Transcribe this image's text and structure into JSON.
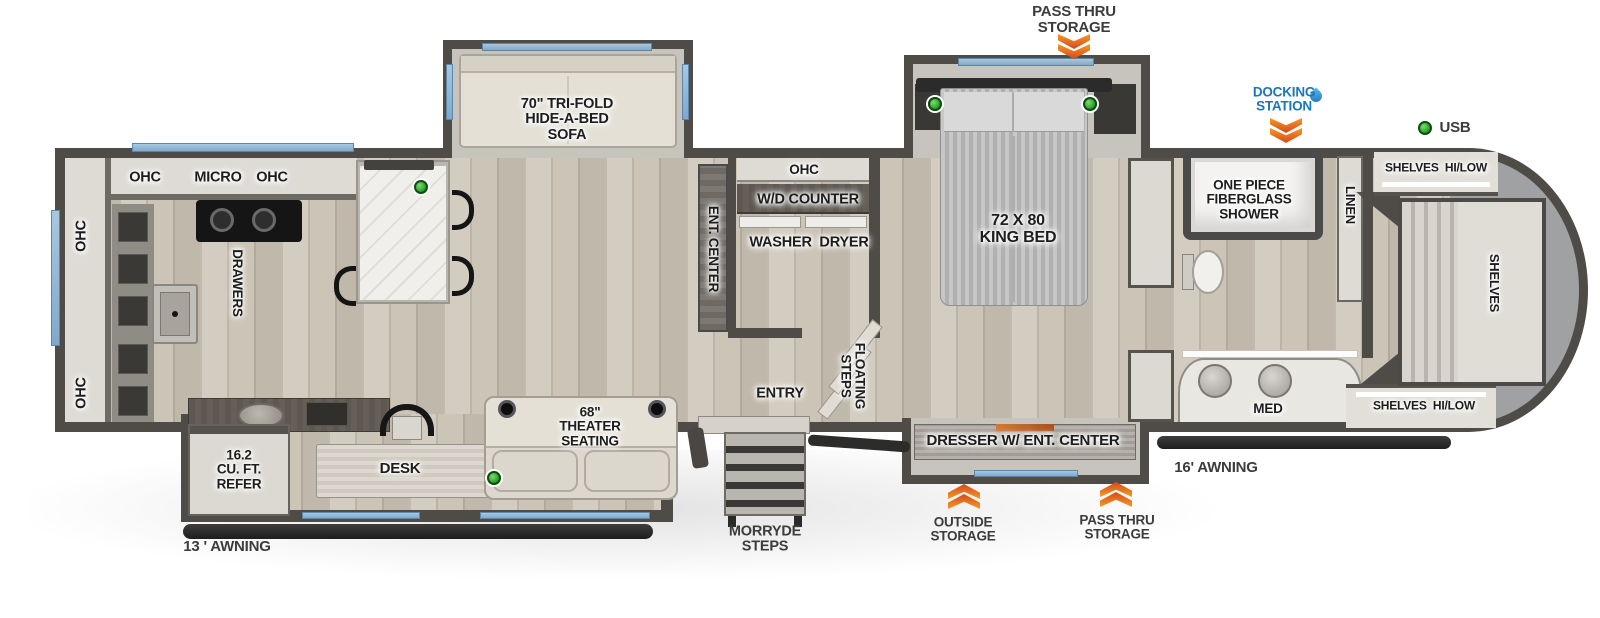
{
  "colors": {
    "wall": "#4f4c48",
    "window_blue": "#8ab4d6",
    "accent_orange": "#e2701f",
    "docking_blue": "#1b75bb",
    "indicator_green": "#2ca22c",
    "floor_wood": "#c8c0b2",
    "front_cap_gray": "#9fa1a3"
  },
  "exterior": {
    "pass_thru_storage_top": "PASS THRU\nSTORAGE",
    "docking_station": "DOCKING\nSTATION",
    "usb": "USB",
    "awning_right": "16' AWNING",
    "outside_storage": "OUTSIDE\nSTORAGE",
    "pass_thru_storage_bottom": "PASS THRU\nSTORAGE",
    "morryde_steps": "MORRYDE\nSTEPS",
    "awning_left": "13 ' AWNING"
  },
  "kitchen": {
    "ohc_rear_left": "OHC",
    "micro": "MICRO",
    "ohc_rear_right": "OHC",
    "ohc_side_upper": "OHC",
    "ohc_side_lower": "OHC",
    "drawers": "DRAWERS",
    "refer": "16.2\nCU. FT.\nREFER"
  },
  "living": {
    "sofa": "70\" TRI-FOLD\nHIDE-A-BED\nSOFA",
    "theater_seating": "68\"\nTHEATER\nSEATING",
    "desk": "DESK",
    "ent_center": "ENT. CENTER"
  },
  "laundry": {
    "ohc": "OHC",
    "wd_counter": "W/D COUNTER",
    "washer_dryer": "WASHER  DRYER"
  },
  "entry_area": {
    "entry": "ENTRY",
    "floating_steps": "FLOATING\nSTEPS"
  },
  "bedroom": {
    "king_bed": "72 X 80\nKING BED",
    "dresser": "DRESSER W/ ENT. CENTER"
  },
  "bathroom": {
    "shower": "ONE PIECE\nFIBERGLASS\nSHOWER",
    "med": "MED",
    "linen": "LINEN"
  },
  "front_closet": {
    "shelves_hilow_top": "SHELVES  HI/LOW",
    "shelves": "SHELVES",
    "shelves_hilow_bottom": "SHELVES  HI/LOW"
  }
}
